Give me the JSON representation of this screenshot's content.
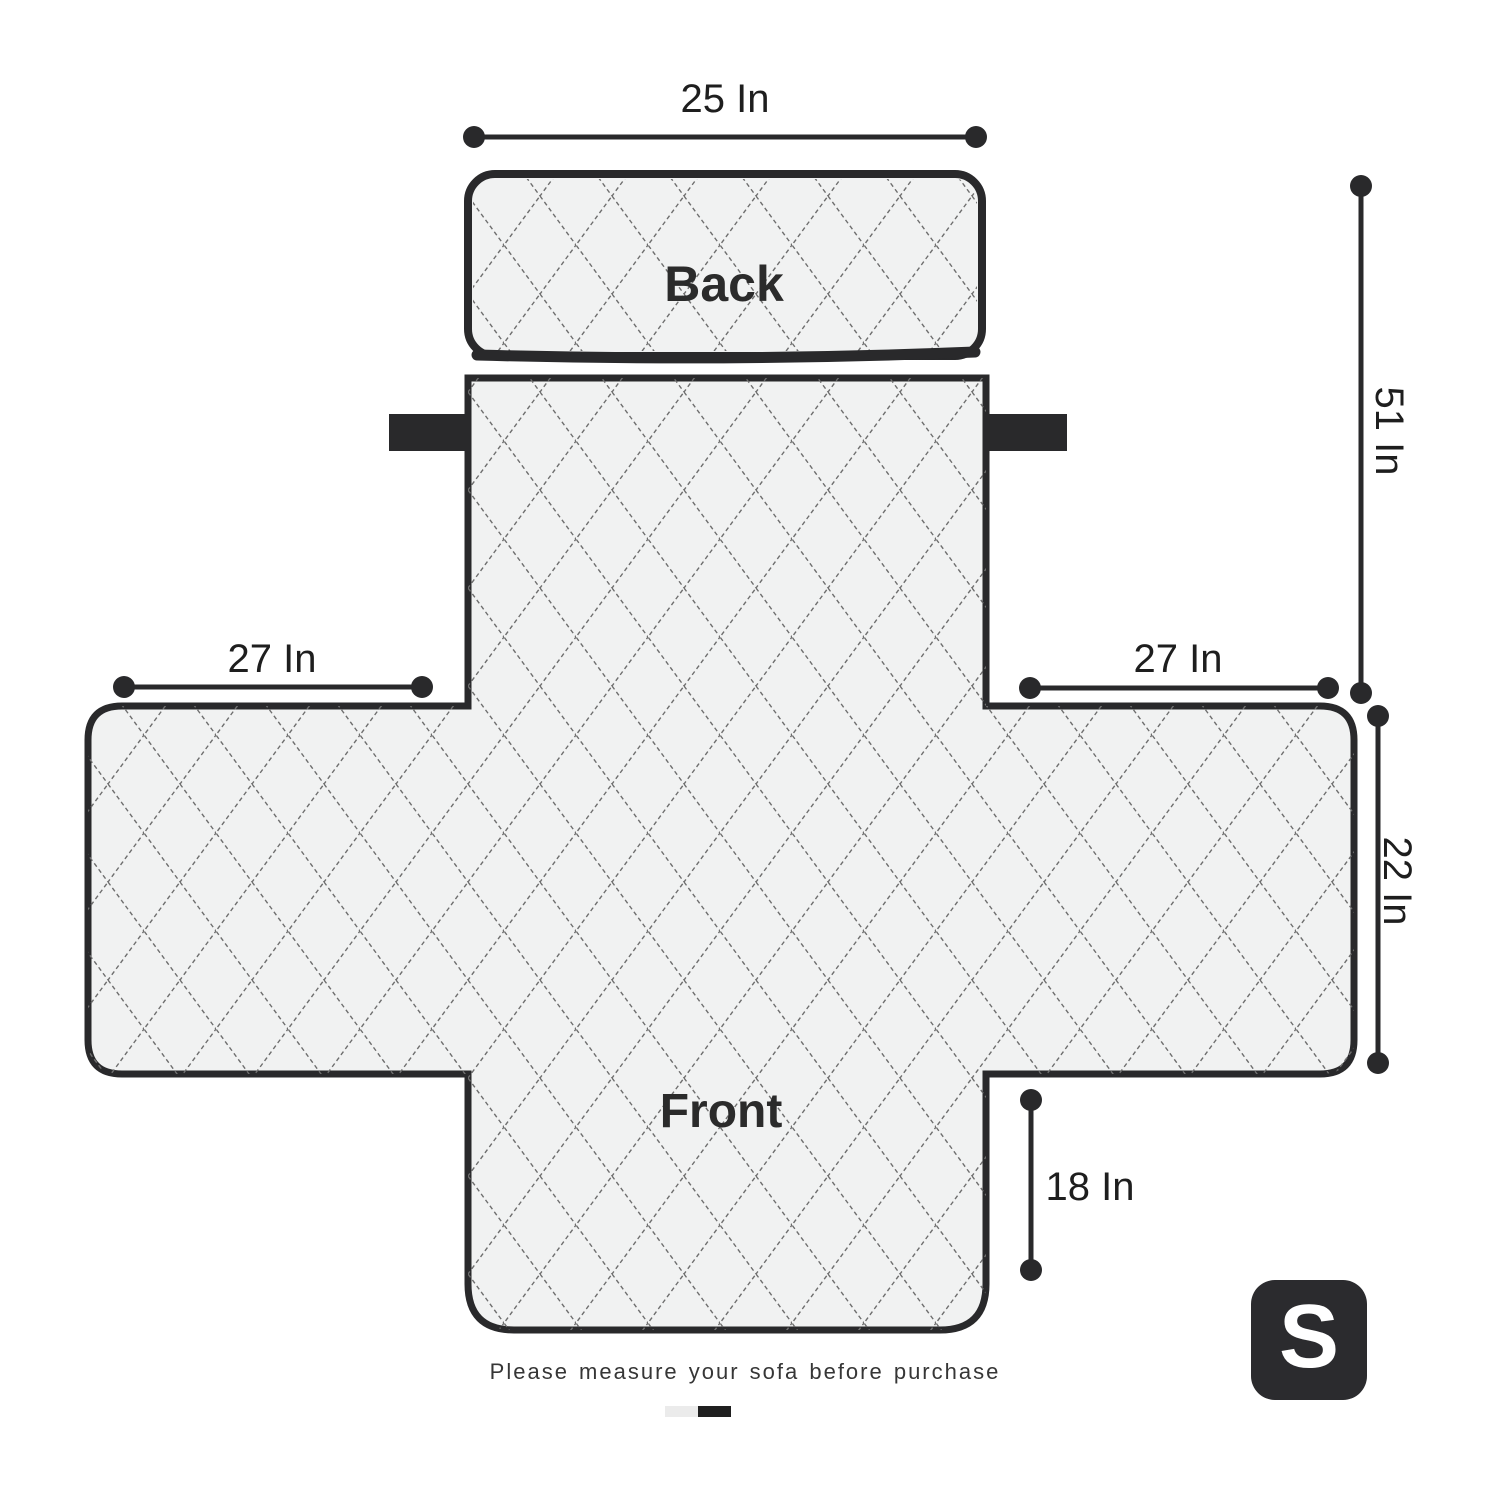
{
  "diagram": {
    "title_type": "sofa-cover-measurement-diagram",
    "back_label": "Back",
    "front_label": "Front",
    "note": "Please measure your sofa before purchase",
    "size_badge": "S",
    "dimensions": {
      "back_width": {
        "label": "25 In",
        "value": 25,
        "unit": "In",
        "where": "top back panel width"
      },
      "total_length": {
        "label": "51 In",
        "value": 51,
        "unit": "In",
        "where": "right side overall length"
      },
      "left_arm_width": {
        "label": "27 In",
        "value": 27,
        "unit": "In",
        "where": "left armrest width"
      },
      "right_arm_width": {
        "label": "27 In",
        "value": 27,
        "unit": "In",
        "where": "right armrest width"
      },
      "arm_depth": {
        "label": "22 In",
        "value": 22,
        "unit": "In",
        "where": "armrest depth right side"
      },
      "front_drop": {
        "label": "18 In",
        "value": 18,
        "unit": "In",
        "where": "front flap drop"
      }
    },
    "colors": {
      "outline": "#29292b",
      "fill": "#f1f2f2",
      "quilt_line": "#6e6e6e",
      "strap": "#29292b",
      "badge_bg": "#2b2b2e",
      "badge_text": "#ffffff",
      "swatch_light": "#ebebeb",
      "swatch_dark": "#1f1f1f",
      "label_text": "#1e1e1e"
    }
  }
}
